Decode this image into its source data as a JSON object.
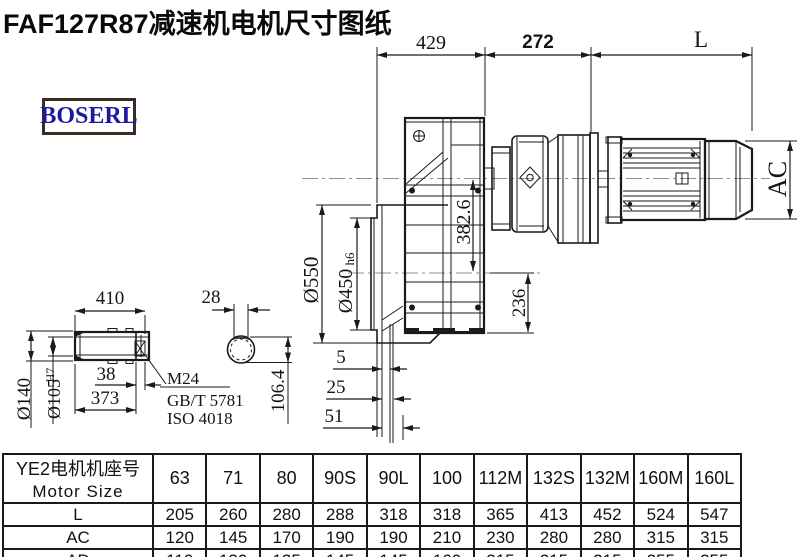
{
  "title": "FAF127R87减速机电机尺寸图纸",
  "logo": {
    "text": "BOSERL",
    "text_color": "#1b1b9e",
    "border_color": "#3d2b22"
  },
  "drawing": {
    "dims": {
      "overall_gearbox": "429",
      "adapter_length": "272",
      "motor_length": "L",
      "motor_diameter": "AC",
      "flange_od": "Ø550",
      "spigot_d": "Ø450",
      "spigot_tol": "h6",
      "axis_height": "382.6",
      "axis_to_bottom": "236",
      "shaft_length": "410",
      "keyway_width": "28",
      "shaft_od": "Ø140",
      "bore_d": "Ø105",
      "bore_tol": "H7",
      "end_step": "38",
      "shaft_step": "373",
      "bore_keyway": "106.4",
      "face_offset_1": "5",
      "face_offset_2": "25",
      "face_offset_3": "51"
    },
    "notes": [
      "M24",
      "GB/T 5781",
      "ISO 4018"
    ]
  },
  "table": {
    "header_cn": "YE2电机机座号",
    "header_en": "Motor Size",
    "columns": [
      "63",
      "71",
      "80",
      "90S",
      "90L",
      "100",
      "112M",
      "132S",
      "132M",
      "160M",
      "160L"
    ],
    "rows": [
      {
        "label": "L",
        "values": [
          "205",
          "260",
          "280",
          "288",
          "318",
          "318",
          "365",
          "413",
          "452",
          "524",
          "547"
        ]
      },
      {
        "label": "AC",
        "values": [
          "120",
          "145",
          "170",
          "190",
          "190",
          "210",
          "230",
          "280",
          "280",
          "315",
          "315"
        ]
      },
      {
        "label": "AD",
        "values": [
          "110",
          "130",
          "135",
          "145",
          "145",
          "160",
          "215",
          "215",
          "215",
          "255",
          "255"
        ]
      }
    ]
  }
}
